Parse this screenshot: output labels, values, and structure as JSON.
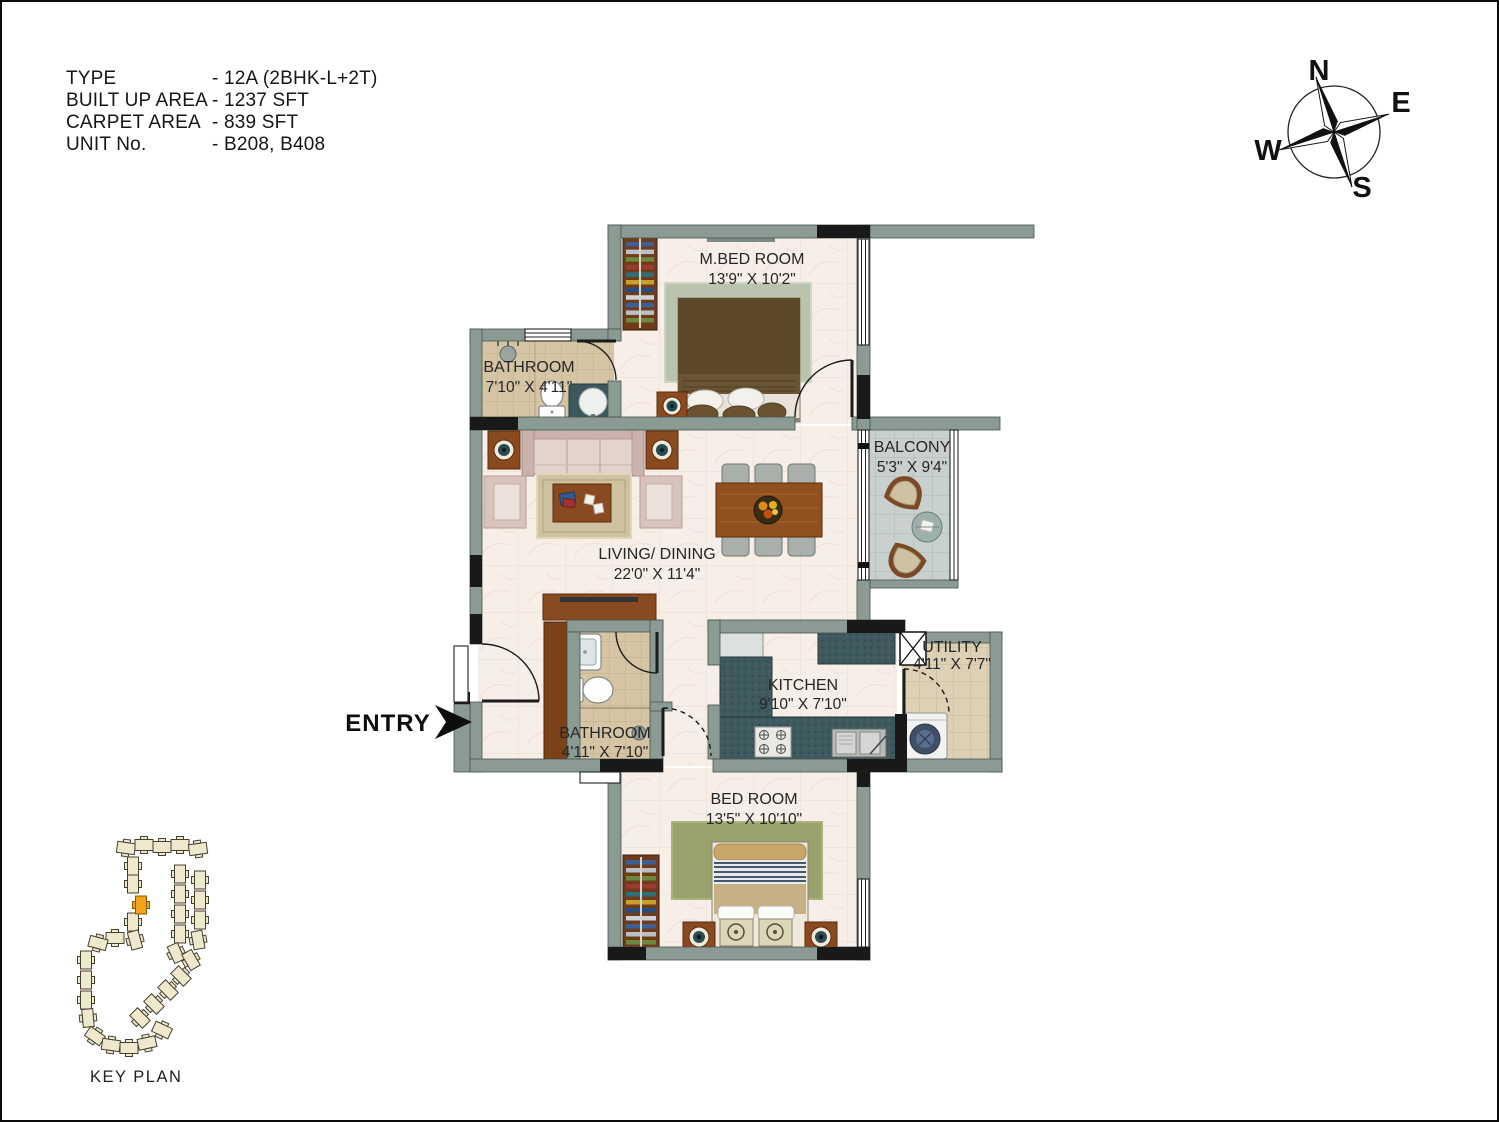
{
  "header": {
    "rows": [
      {
        "label": "TYPE",
        "value": "- 12A (2BHK-L+2T)"
      },
      {
        "label": "BUILT UP AREA",
        "value": "- 1237 SFT"
      },
      {
        "label": "CARPET AREA",
        "value": "- 839 SFT"
      },
      {
        "label": "UNIT No.",
        "value": "- B208, B408"
      }
    ]
  },
  "compass": {
    "north": "N",
    "east": "E",
    "south": "S",
    "west": "W"
  },
  "entry_label": "ENTRY",
  "key_plan_label": "KEY PLAN",
  "rooms": {
    "master_bedroom": {
      "name": "M.BED ROOM",
      "dims": "13'9\" X 10'2\""
    },
    "bathroom_top": {
      "name": "BATHROOM",
      "dims": "7'10\" X 4'11\""
    },
    "balcony": {
      "name": "BALCONY",
      "dims": "5'3\" X 9'4\""
    },
    "living_dining": {
      "name": "LIVING/ DINING",
      "dims": "22'0\" X 11'4\""
    },
    "bathroom_main": {
      "name": "BATHROOM",
      "dims": "4'11\" X 7'10\""
    },
    "kitchen": {
      "name": "KITCHEN",
      "dims": "9'10\" X 7'10\""
    },
    "utility": {
      "name": "UTILITY",
      "dims": "4'11\" X 7'7\""
    },
    "bedroom": {
      "name": "BED ROOM",
      "dims": "13'5\" X 10'10\""
    }
  },
  "colors": {
    "wall": "#8c9a94",
    "accent_black": "#191919",
    "floor_cream": "#f7eee8",
    "floor_tile_tan": "#d6c5a5",
    "floor_tile_gray": "#c9d0cd",
    "counter_teal": "#3f5a5e",
    "wood": "#8a4a20",
    "keyplan_highlight": "#f2a31c"
  }
}
